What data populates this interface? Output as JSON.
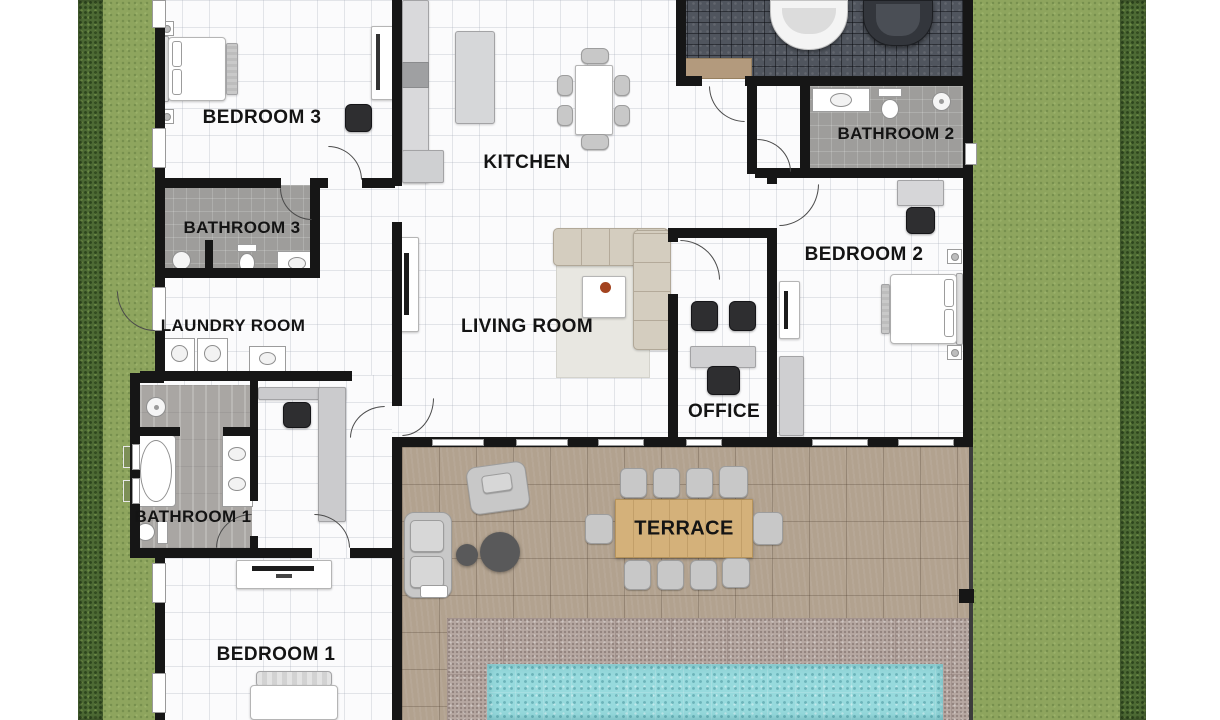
{
  "plan": {
    "type": "residential-floor-plan",
    "labels": {
      "bedroom3": "BEDROOM 3",
      "kitchen": "KITCHEN",
      "bathroom3": "BATHROOM 3",
      "laundry": "LAUNDRY ROOM",
      "living": "LIVING ROOM",
      "office": "OFFICE",
      "bathroom1": "BATHROOM 1",
      "bedroom1": "BEDROOM 1",
      "bedroom2": "BEDROOM 2",
      "bathroom2": "BATHROOM 2",
      "terrace": "TERRACE"
    },
    "features": [
      "double-bed",
      "single-bed",
      "bathtub",
      "shower",
      "toilet",
      "double-sink-vanity",
      "washing-machine",
      "dryer",
      "kitchen-island",
      "dining-table-6-chairs",
      "l-shaped-sofa",
      "coffee-table",
      "tv-console",
      "office-desk",
      "office-chairs",
      "wardrobe",
      "garage-two-cars",
      "terrace-dining-table-10-chairs",
      "lounge-armchairs",
      "side-tables",
      "swimming-pool",
      "hedge",
      "lawn"
    ]
  },
  "palette": {
    "grass": "#8ea55e",
    "hedge": "#4d6a34",
    "wall": "#161616",
    "floor": "#fbfbfc",
    "bath_tile": "#9e9d9b",
    "garage_tile": "#50555e",
    "deck_wood": "#b2a28f",
    "pool_surround_stone": "#b6a8a2",
    "pool_water": "#97dadd",
    "terrace_table_wood": "#d4b17a",
    "furniture_light": "#cbcbcd",
    "furniture_dark": "#2e2e30",
    "label_text": "#141414"
  }
}
